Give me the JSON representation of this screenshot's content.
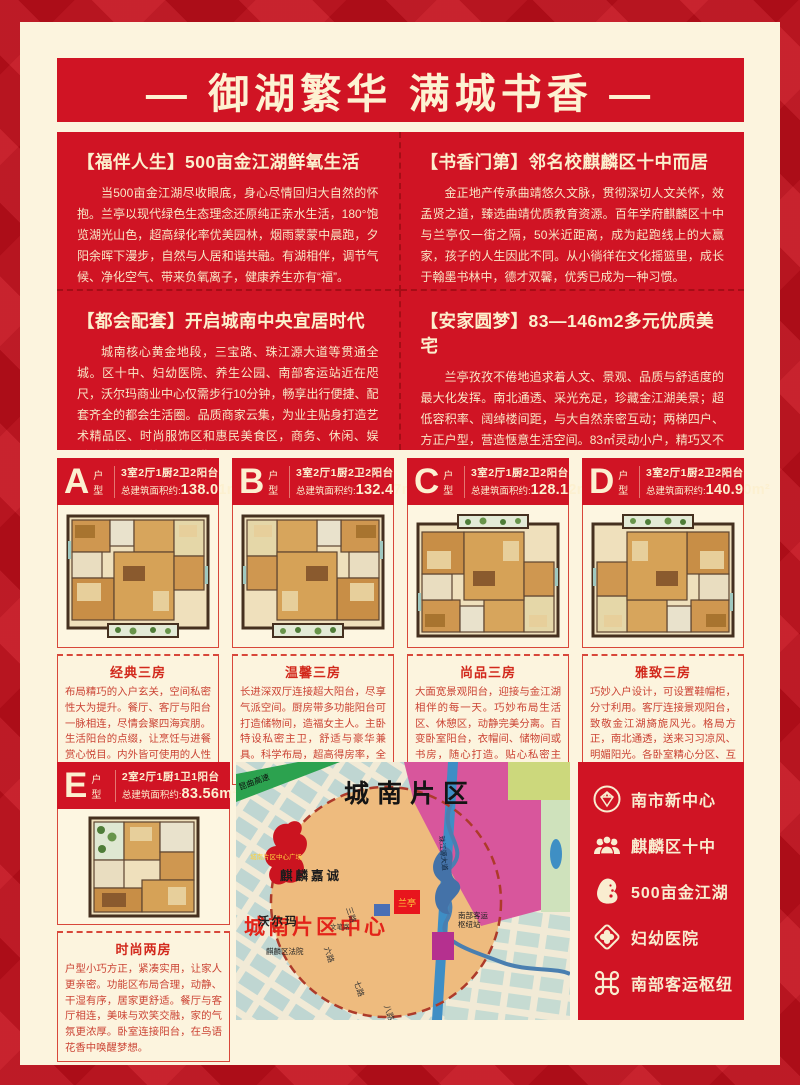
{
  "title": "— 御湖繁华  满城书香 —",
  "sections": [
    {
      "heading": "【福伴人生】500亩金江湖鲜氧生活",
      "body": "当500亩金江湖尽收眼底，身心尽情回归大自然的怀抱。兰亭以现代绿色生态理念还原纯正亲水生活，180°饱览湖光山色，超高绿化率优美园林，烟雨蒙蒙中晨跑，夕阳余晖下漫步，自然与人居和谐共融。有湖相伴，调节气候、净化空气、带来负氧离子，健康养生亦有“福”。"
    },
    {
      "heading": "【书香门第】邻名校麒麟区十中而居",
      "body": "金正地产传承曲靖悠久文脉，贯彻深切人文关怀，效孟贤之道，臻选曲靖优质教育资源。百年学府麒麟区十中与兰亭仅一街之隔，50米近距离，成为起跑线上的大赢家，孩子的人生因此不同。从小徜徉在文化摇篮里，成长于翰墨书林中，德才双馨，优秀已成为一种习惯。"
    },
    {
      "heading": "【都会配套】开启城南中央宜居时代",
      "body": "城南核心黄金地段，三宝路、珠江源大道等贯通全城。区十中、妇幼医院、养生公园、南部客运站近在咫尺，沃尔玛商业中心仅需步行10分钟，畅享出行便捷、配套齐全的都会生活圈。品质商家云集，为业主贴身打造艺术精品区、时尚服饰区和惠民美食区，商务、休闲、娱乐、购物、餐饮一站式满足。"
    },
    {
      "heading": "【安家圆梦】83—146m2多元优质美宅",
      "body": "兰亭孜孜不倦地追求着人文、景观、品质与舒适度的最大化发挥。南北通透、采光充足，珍藏金江湖美景；超低容积率、阔绰楼间距，与大自然亲密互动；两梯四户、方正户型，营造惬意生活空间。83㎡灵动小户，精巧又不失温馨；128-146㎡舒敞大宅，三代同堂和乐融融。相伴，调节气候、净化空气、带来负氧离子，健康养生亦有“福”。"
    }
  ],
  "units": [
    {
      "letter": "A",
      "type_label": "户型",
      "spec": "3室2厅1厨2卫2阳台",
      "area_label": "总建筑面积约:",
      "area": "138.01m²",
      "name": "经典三房",
      "desc": "布局精巧的入户玄关，空间私密性大为提升。餐厅、客厅与阳台一脉相连，尽情会聚四海宾朋。生活阳台的点缀，让烹饪与进餐赏心悦目。内外皆可使用的人性化主卫，点滴之间便利生活。"
    },
    {
      "letter": "B",
      "type_label": "户型",
      "spec": "3室2厅1厨2卫2阳台",
      "area_label": "总建筑面积约:",
      "area": "132.47m²",
      "name": "温馨三房",
      "desc": "长进深双厅连接超大阳台，尽享气派空间。厨房带多功能阳台可打造储物间，造福女主人。主卧特设私密主卫，舒适与豪华兼具。科学布局，超高得房率，全面满足居家需求。"
    },
    {
      "letter": "C",
      "type_label": "户型",
      "spec": "3室2厅1厨2卫2阳台",
      "area_label": "总建筑面积约:",
      "area": "128.12m²",
      "name": "尚品三房",
      "desc": "大面宽景观阳台，迎接与金江湖相伴的每一天。巧妙布局生活区、休憩区，动静完美分离。百变卧室阳台，衣帽间、储物间或书房，随心打造。贴心私密主卫，关爱居家感受，从细节开始。"
    },
    {
      "letter": "D",
      "type_label": "户型",
      "spec": "3室2厅1厨2卫2阳台",
      "area_label": "总建筑面积约:",
      "area": "140.90m²",
      "name": "雅致三房",
      "desc": "巧妙入户设计，可设置鞋帽柜，分寸利用。客厅连接景观阳台，致敬金江湖旖旎风光。格局方正，南北通透，送来习习凉风、明媚阳光。各卧室精心分区、互不干扰，给孩子空间，给老人宁静。"
    },
    {
      "letter": "E",
      "type_label": "户型",
      "spec": "2室2厅1厨1卫1阳台",
      "area_label": "总建筑面积约:",
      "area": "83.56m²",
      "name": "时尚两房",
      "desc": "户型小巧方正，紧凑实用，让家人更亲密。功能区布局合理，动静、干湿有序，居家更舒适。餐厅与客厅相连，美味与欢笑交融，家的气氛更浓厚。卧室连接阳台，在鸟语花香中唤醒梦想。"
    }
  ],
  "map": {
    "district": "城南片区",
    "center_label": "城南片区中心",
    "highway": "昆曲高速",
    "plaza": "城南片区中心广场",
    "estate": "麒麟嘉诚",
    "walmart": "沃尔玛",
    "project": "兰亭",
    "hub_line1": "南部客运",
    "hub_line2": "枢纽站",
    "court": "麒麟区法院",
    "avenue": "珠江源大道",
    "roads": [
      "三路",
      "六路",
      "七路",
      "八路",
      "文笔路"
    ]
  },
  "sidebar": {
    "items": [
      {
        "icon": "diamond-icon",
        "label": "南市新中心"
      },
      {
        "icon": "people-icon",
        "label": "麒麟区十中"
      },
      {
        "icon": "lake-icon",
        "label": "500亩金江湖"
      },
      {
        "icon": "medical-cross-icon",
        "label": "妇幼医院"
      },
      {
        "icon": "transit-hub-icon",
        "label": "南部客运枢纽"
      }
    ]
  },
  "colors": {
    "red": "#d01424",
    "dark_red": "#a60d16",
    "cream": "#fcf4de",
    "text_cream": "#f8e7c6",
    "desc_red": "#cb4334",
    "map_magenta": "#d8569c",
    "map_orange": "#eebb7e",
    "map_green": "#2ca24f"
  }
}
